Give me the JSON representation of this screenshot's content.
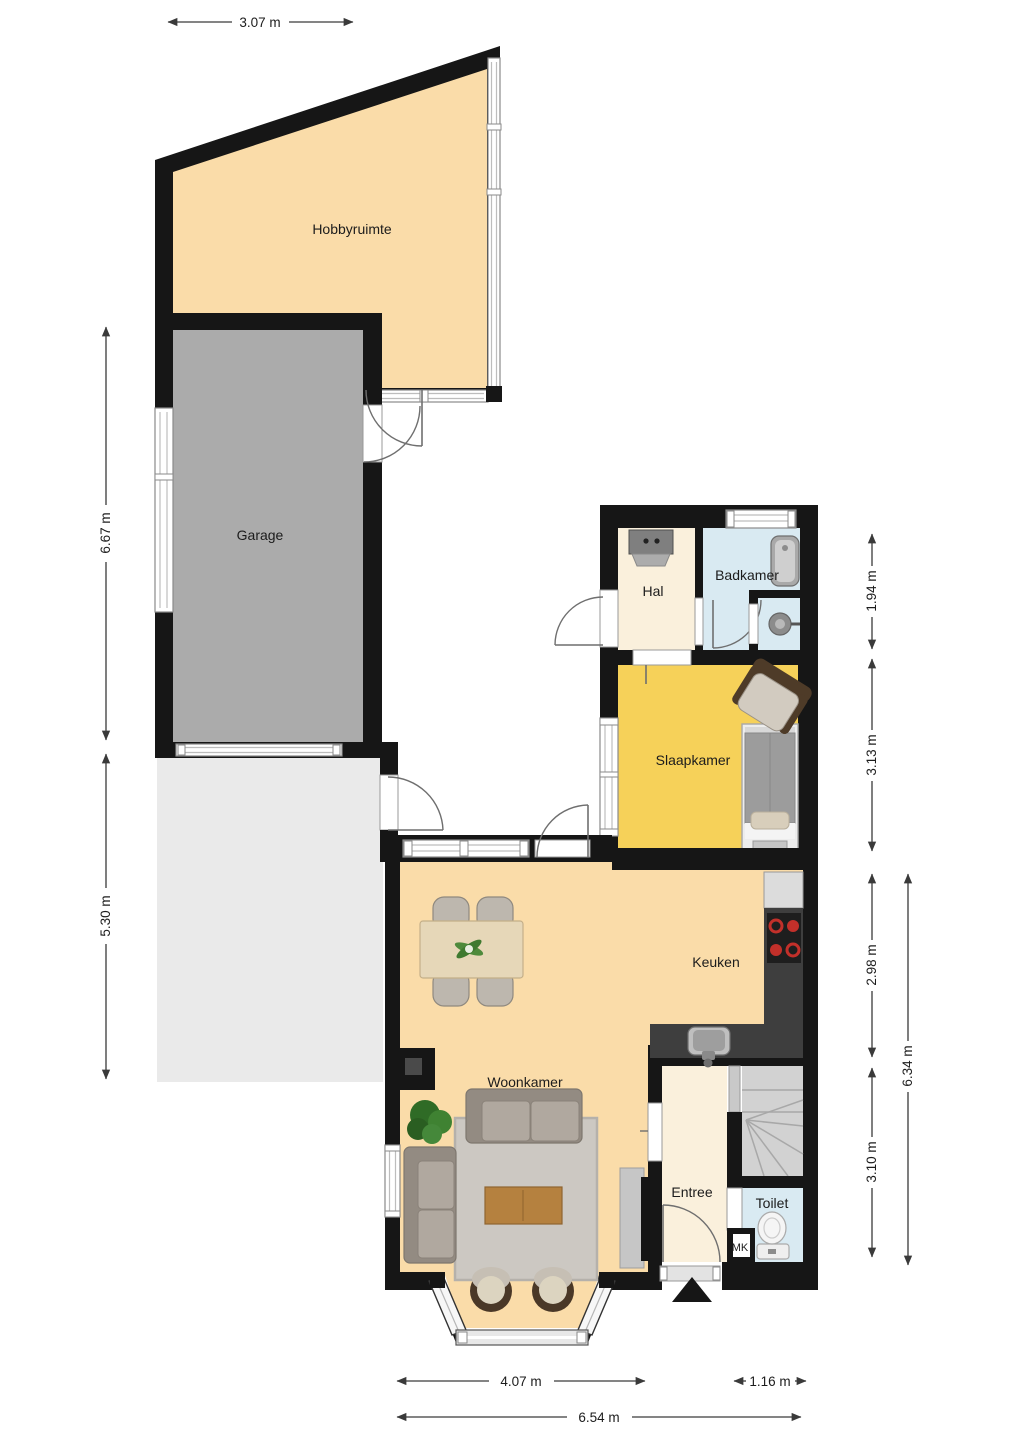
{
  "floorplan": {
    "rooms": {
      "hobbyruimte": "Hobbyruimte",
      "garage": "Garage",
      "hal": "Hal",
      "badkamer": "Badkamer",
      "slaapkamer": "Slaapkamer",
      "keuken": "Keuken",
      "woonkamer": "Woonkamer",
      "entree": "Entree",
      "toilet": "Toilet",
      "meterkast": "MK"
    },
    "dimensions": {
      "hobby_width": "3.07 m",
      "garage_height": "6.67 m",
      "patio_height": "5.30 m",
      "badkamer_height": "1.94 m",
      "slaapkamer_height": "3.13 m",
      "keuken_height": "2.98 m",
      "woonkamer_height": "3.10 m",
      "right_total_height": "6.34 m",
      "woonkamer_width": "4.07 m",
      "entree_width": "1.16 m",
      "bottom_total_width": "6.54 m"
    },
    "fixtures": [
      "washer",
      "bathtub",
      "basin",
      "bed",
      "armchair",
      "cooktop",
      "fridge-counter",
      "kitchen-sink",
      "dining-table",
      "dining-chairs",
      "sofa",
      "rug",
      "coffee-table",
      "plant",
      "tv-sideboard",
      "bay-chairs",
      "stairs",
      "toilet",
      "entrance-arrow"
    ],
    "colors": {
      "wall": "#161616",
      "room_peach": "#FADCA9",
      "room_cream": "#FAF0DC",
      "room_yellow": "#F6D159",
      "room_blue": "#D9EAF2",
      "garage_gray": "#ABABAB",
      "patio_gray": "#EAEAEA",
      "counter_dark": "#3E3E3E",
      "stairs_gray": "#D2D2D2",
      "burner_red": "#C2302A"
    }
  }
}
